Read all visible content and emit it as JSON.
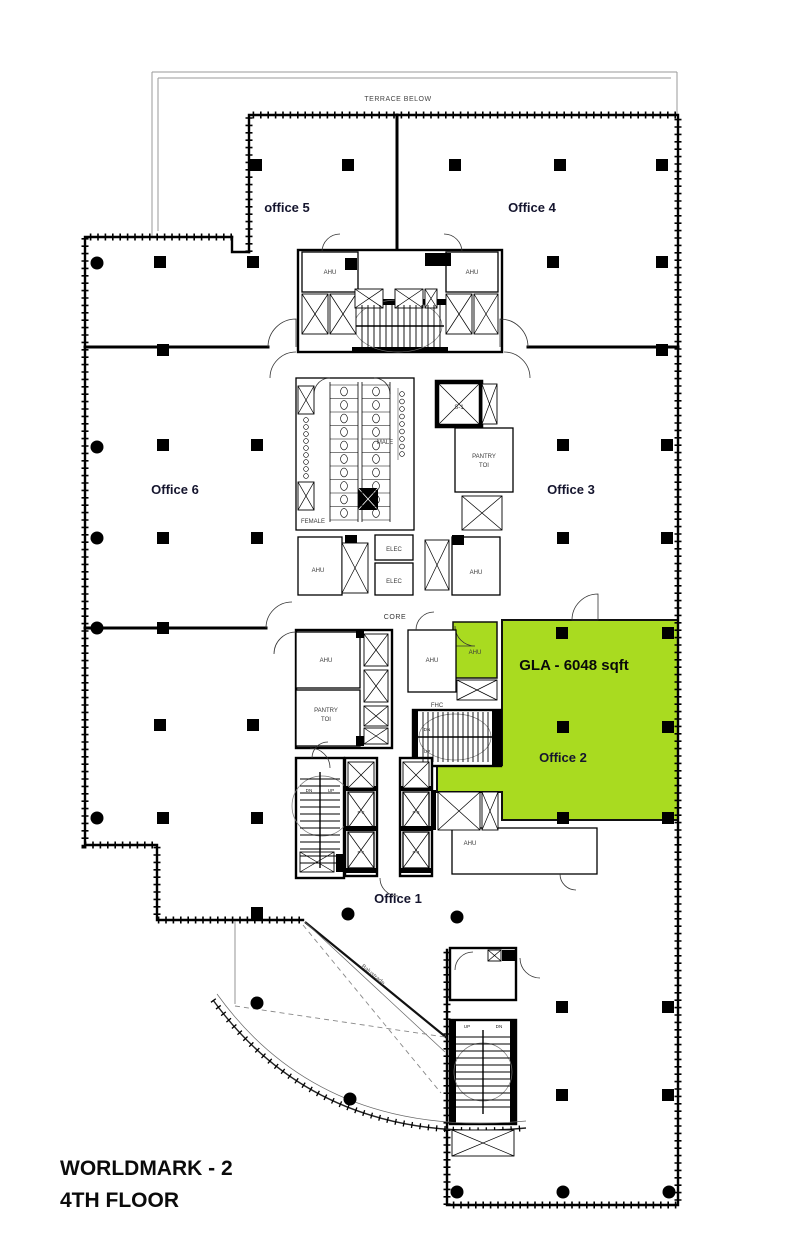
{
  "plan": {
    "terrace_note": "TERRACE BELOW",
    "core_label": "CORE",
    "balustrade_note": "Balustrade",
    "gla": "GLA - 6048 sqft",
    "highlight_color": "#A9DB20",
    "offices": {
      "office5": "office 5",
      "office4": "Office 4",
      "office6": "Office 6",
      "office3": "Office 3",
      "office2": "Office 2",
      "office1": "Office 1"
    },
    "rooms": {
      "ahu": "AHU",
      "male": "MALE",
      "female": "FEMALE",
      "pantry_line1": "PANTRY",
      "pantry_line2": "TOI",
      "elec": "ELEC",
      "fhc": "FHC",
      "s1": "S-1",
      "up": "UP",
      "dn": "DN"
    },
    "lifts": [
      "P-2",
      "P-1",
      "P-3",
      "P-4"
    ],
    "title_line1": "WORLDMARK - 2",
    "title_line2": "4TH FLOOR"
  }
}
